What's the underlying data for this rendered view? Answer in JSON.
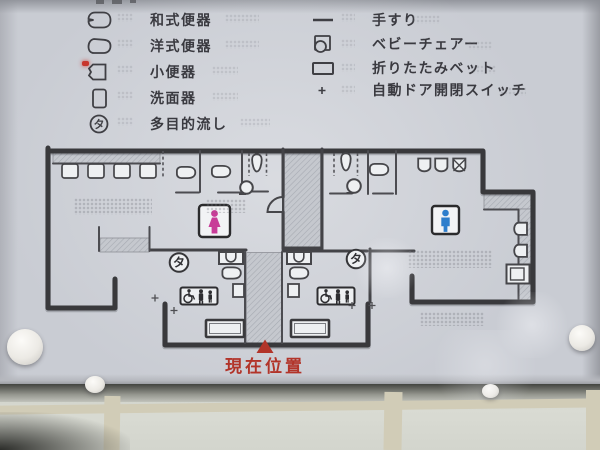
{
  "symbols": {
    "ta": "タ"
  },
  "legend": {
    "left": [
      {
        "label": "和式便器"
      },
      {
        "label": "洋式便器"
      },
      {
        "label": "小便器"
      },
      {
        "label": "洗面器"
      },
      {
        "label": "多目的流し"
      }
    ],
    "right": [
      {
        "label": "手すり"
      },
      {
        "label": "ベビーチェアー"
      },
      {
        "label": "折りたたみベット"
      },
      {
        "label": "自動ドア開閉スイッチ"
      }
    ]
  },
  "plan": {
    "current_location": "現在位置"
  },
  "colors": {
    "women_pink": "#c83c98",
    "men_blue": "#2e7ecc",
    "marker_red": "#b23429",
    "wall": "#39393c"
  }
}
